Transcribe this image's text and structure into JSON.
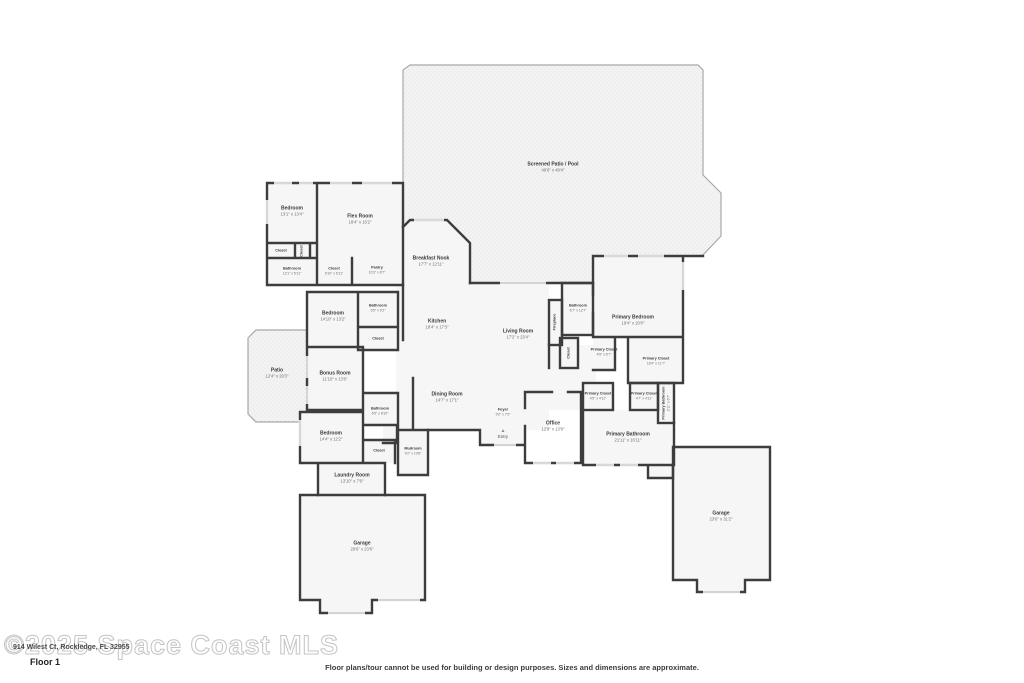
{
  "plan": {
    "entry": {
      "label": "Entry",
      "icon_glyph": "▲"
    },
    "rooms": [
      {
        "name": "Screened Patio / Pool",
        "dims": "49'6\" x 48'4\""
      },
      {
        "name": "Bedroom",
        "dims": "13'1\" x 13'4\""
      },
      {
        "name": "Flex Room",
        "dims": "18'4\" x 16'2\""
      },
      {
        "name": "Closet",
        "dims": ""
      },
      {
        "name": "Closet",
        "dims": ""
      },
      {
        "name": "Bathroom",
        "dims": "12'1\" x 5'11\""
      },
      {
        "name": "Closet",
        "dims": "6'10\" x 6'11\""
      },
      {
        "name": "Pantry",
        "dims": "10'3\" x 8'7\""
      },
      {
        "name": "Breakfast Nook",
        "dims": "17'7\" x 12'11\""
      },
      {
        "name": "Kitchen",
        "dims": "18'4\" x 17'3\""
      },
      {
        "name": "Living Room",
        "dims": "17'2\" x 23'4\""
      },
      {
        "name": "Fireplace",
        "dims": ""
      },
      {
        "name": "Bathroom",
        "dims": "6'7\" x 12'7\""
      },
      {
        "name": "Closet",
        "dims": ""
      },
      {
        "name": "Primary Bedroom",
        "dims": "19'4\" x 20'0\""
      },
      {
        "name": "Primary Closet",
        "dims": "4'5\" x 6'7\""
      },
      {
        "name": "Primary Closet",
        "dims": "16'4\" x 11'7\""
      },
      {
        "name": "Primary Closet",
        "dims": "4'5\" x 4'11\""
      },
      {
        "name": "Primary Closet",
        "dims": "4'7\" x 4'11\""
      },
      {
        "name": "Primary Bathroom",
        "dims": "2'11\" x 6'7\""
      },
      {
        "name": "Primary Bathroom",
        "dims": "21'11\" x 16'11\""
      },
      {
        "name": "Office",
        "dims": "12'9\" x 13'9\""
      },
      {
        "name": "Dining Room",
        "dims": "14'7\" x 17'1\""
      },
      {
        "name": "Foyer",
        "dims": "9'2\" x 7'9\""
      },
      {
        "name": "Mudroom",
        "dims": "9'2\" x 10'8\""
      },
      {
        "name": "Bedroom",
        "dims": "14'10\" x 13'2\""
      },
      {
        "name": "Bathroom",
        "dims": "6'5\" x 9'2\""
      },
      {
        "name": "Closet",
        "dims": ""
      },
      {
        "name": "Patio",
        "dims": "12'4\" x 29'3\""
      },
      {
        "name": "Bonus Room",
        "dims": "11'10\" x 13'6\""
      },
      {
        "name": "Bathroom",
        "dims": "6'5\" x 8'10\""
      },
      {
        "name": "Bedroom",
        "dims": "14'4\" x 12'2\""
      },
      {
        "name": "Closet",
        "dims": ""
      },
      {
        "name": "Laundry Room",
        "dims": "13'10\" x 7'6\""
      },
      {
        "name": "Garage",
        "dims": "29'6\" x 23'6\""
      },
      {
        "name": "Garage",
        "dims": "23'6\" x 31'2\""
      }
    ]
  },
  "footer": {
    "address": "914 Wilest Ct, Rockledge, FL 32955",
    "watermark": "©2025 Space Coast MLS",
    "floor_label": "Floor 1",
    "disclaimer": "Floor plans/tour cannot be used for building or design purposes. Sizes and dimensions are approximate."
  }
}
